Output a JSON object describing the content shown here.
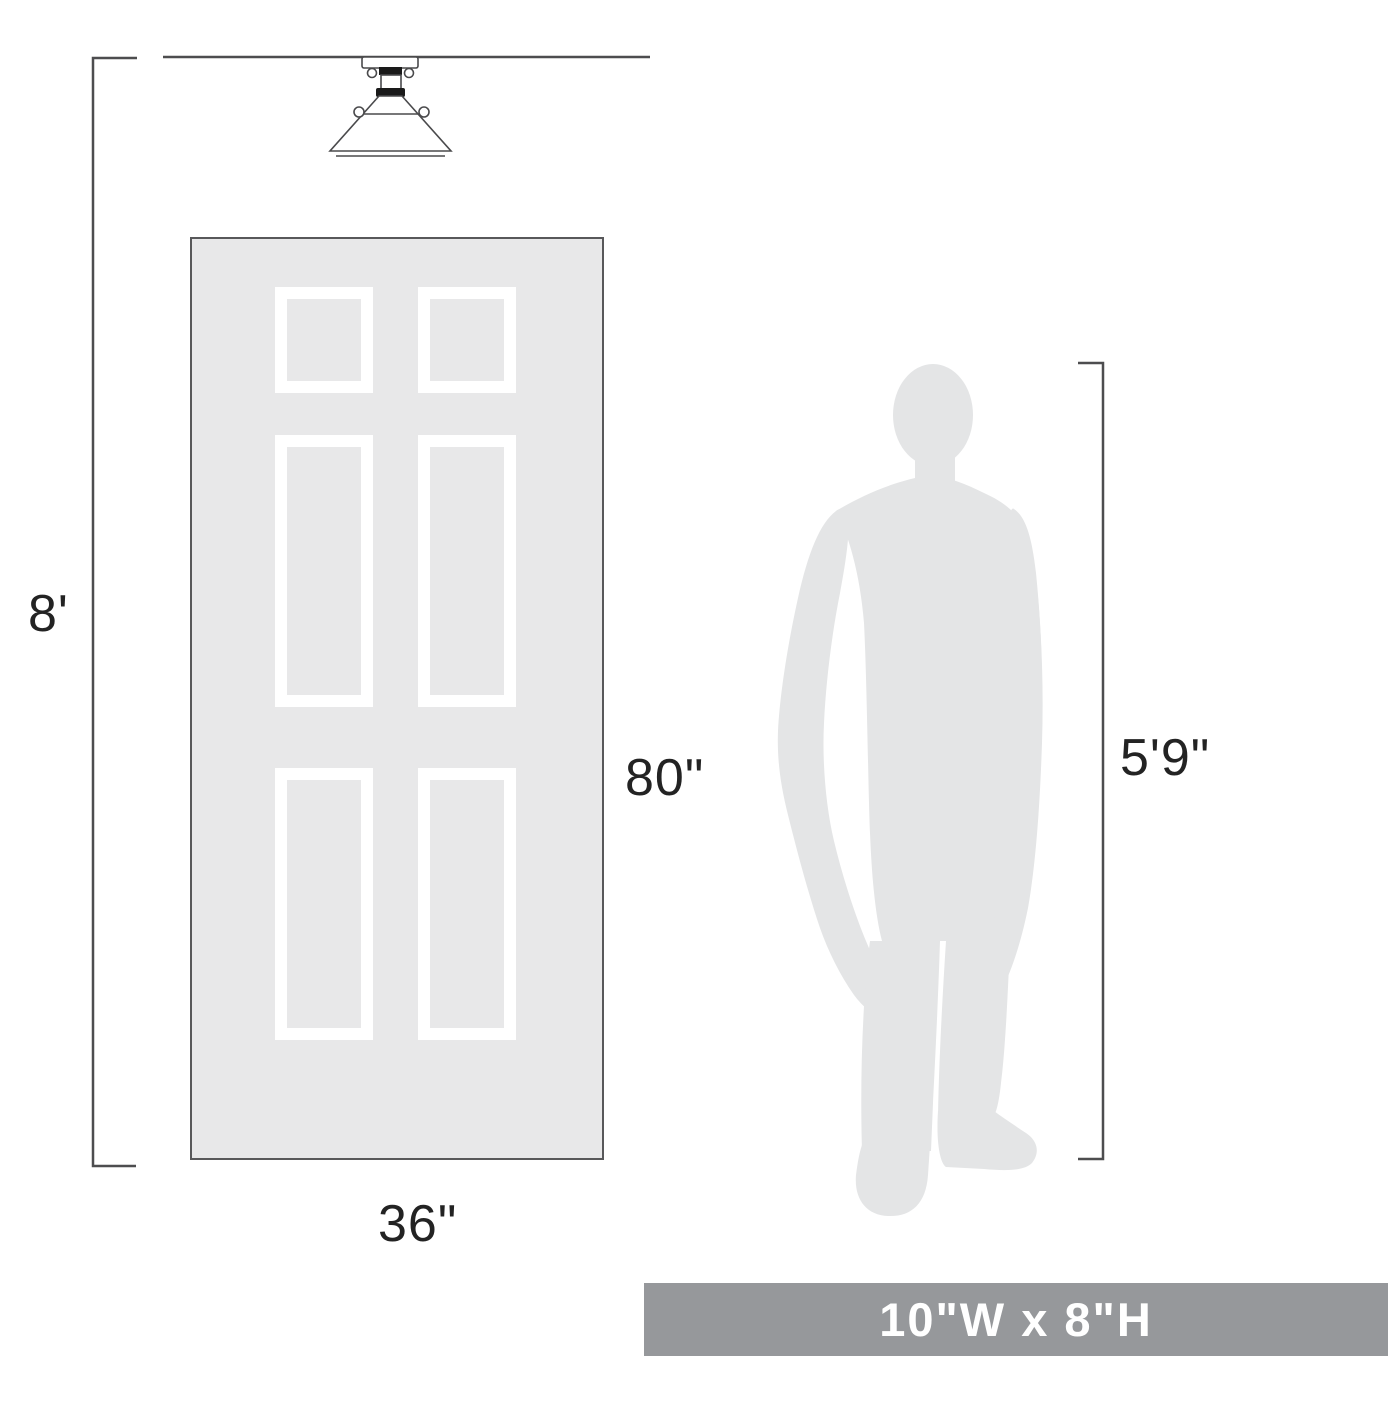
{
  "diagram": {
    "labels": {
      "ceiling_height": "8'",
      "door_height": "80\"",
      "door_width": "36\"",
      "person_height": "5'9\""
    },
    "banner": {
      "text": "10\"W x 8\"H"
    },
    "colors": {
      "door_fill": "#e8e8e9",
      "door_outline": "#58585a",
      "panel_frame": "#ffffff",
      "dimension_line": "#4d4d4f",
      "label_text": "#232323",
      "person_fill": "#e4e5e6",
      "fixture_accent": "#1a1a1a",
      "banner_background": "#96989b",
      "banner_text": "#ffffff",
      "background": "#ffffff"
    },
    "icons": {
      "fixture": "ceiling-light-icon",
      "person": "person-silhouette-icon"
    }
  }
}
